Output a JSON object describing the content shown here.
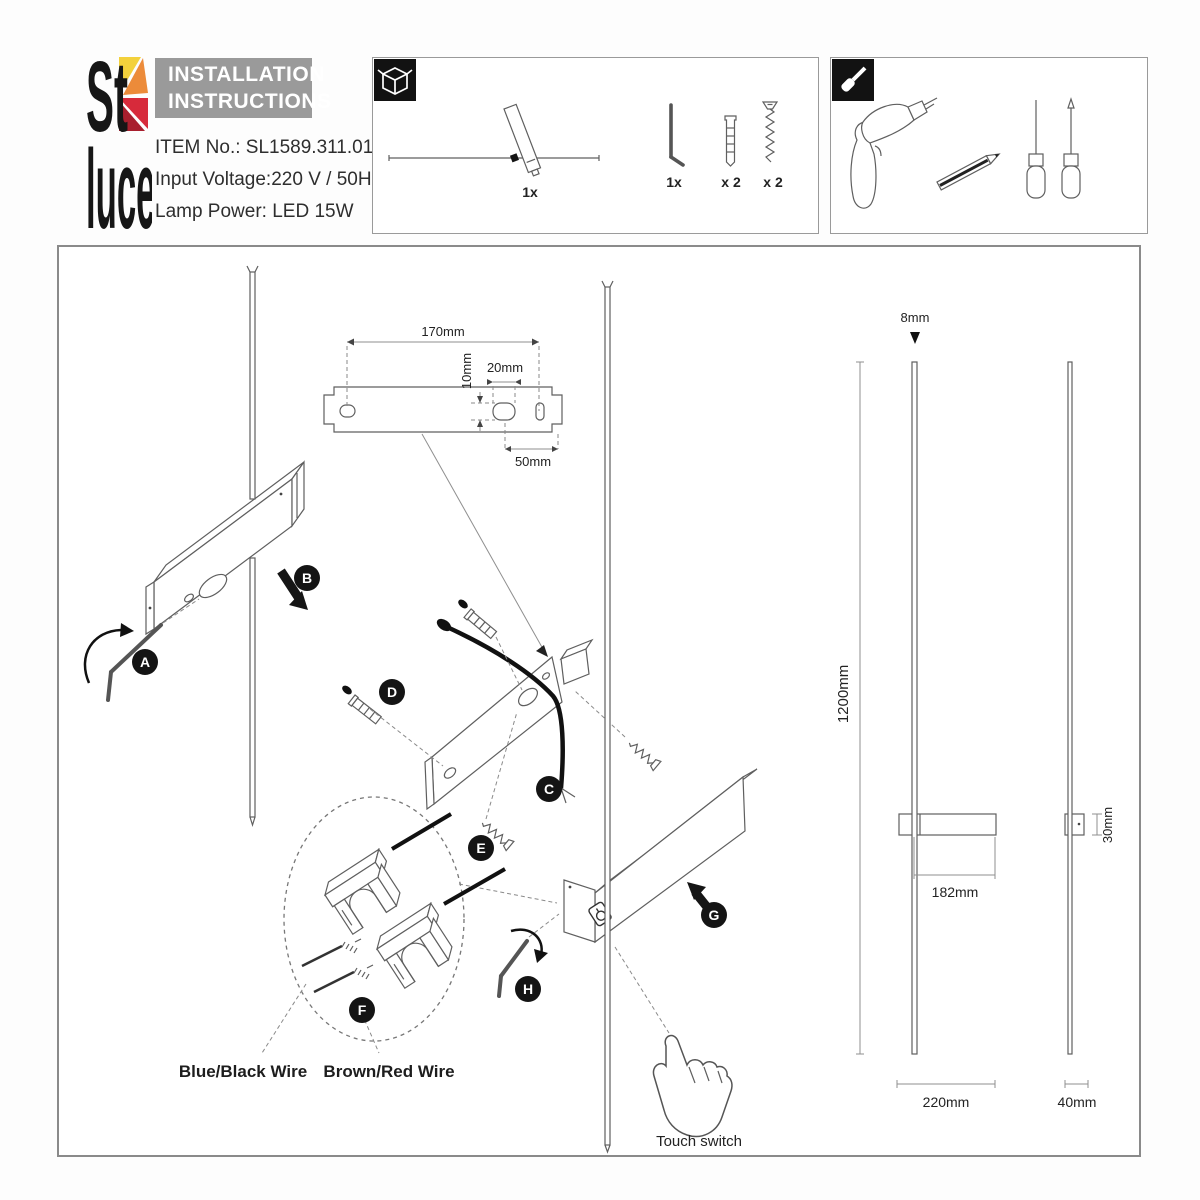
{
  "page": {
    "title": "ST Luce installation instructions sheet"
  },
  "brand": {
    "logo_top": "St",
    "logo_bottom": "luce"
  },
  "header": {
    "title_line1": "INSTALLATION",
    "title_line2": "INSTRUCTIONS",
    "item_no": "ITEM No.: SL1589.311.01",
    "input_voltage": "Input Voltage:220 V / 50Hz",
    "lamp_power": "Lamp Power: LED 15W"
  },
  "package_box": {
    "lamp_qty": "1x",
    "hex_key_qty": "1x",
    "plug_qty": "x 2",
    "screw_qty": "x 2"
  },
  "diagram": {
    "steps": [
      "A",
      "B",
      "C",
      "D",
      "E",
      "F",
      "G",
      "H"
    ],
    "plate_dims": {
      "width": "170mm",
      "slot_height": "10mm",
      "slot_width": "20mm",
      "end_offset": "50mm"
    },
    "wire_labels": {
      "neutral": "Blue/Black Wire",
      "live": "Brown/Red Wire"
    },
    "touch_label": "Touch switch",
    "product_dims": {
      "diameter": "8mm",
      "length": "1200mm",
      "bracket_offset": "182mm",
      "depth": "30mm",
      "body_width": "220mm",
      "side_width": "40mm"
    }
  },
  "colors": {
    "header_gray": "#9a9a9a",
    "line": "#5f5f5f",
    "logo_yellow": "#f3d13c",
    "logo_orange": "#ec8b3a",
    "logo_red": "#d72a3b",
    "logo_dark_red": "#a81f2e"
  }
}
